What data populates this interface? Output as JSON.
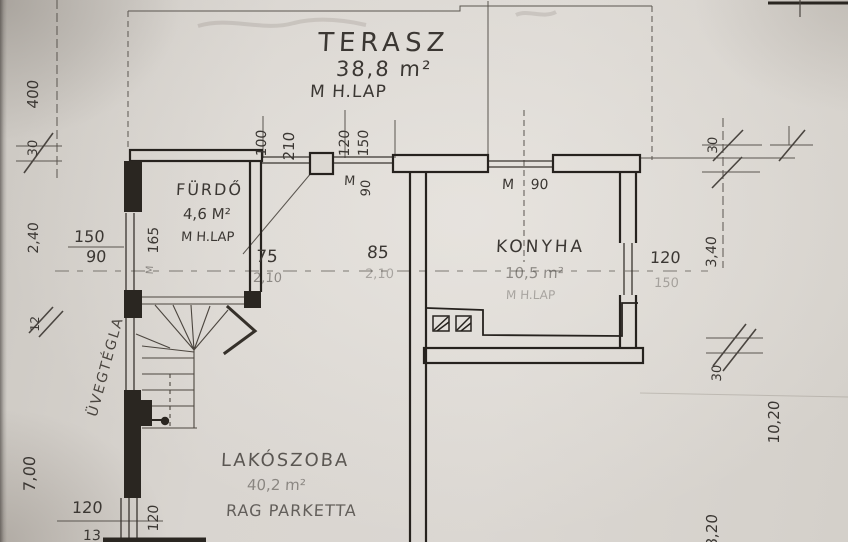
{
  "rooms": {
    "terasz": {
      "name": "TERASZ",
      "area": "38,8 m²",
      "floor": "M H.LAP"
    },
    "furdo": {
      "name": "FÜRDŐ",
      "area": "4,6 M²",
      "floor": "M H.LAP"
    },
    "konyha": {
      "name": "KONYHA",
      "area": "10,5 m²",
      "floor": "M H.LAP"
    },
    "lakoszoba": {
      "name": "LAKÓSZOBA",
      "area": "40,2 m²",
      "floor": "RAG PARKETTA"
    }
  },
  "materials": {
    "glass_brick": "ÜVEGTÉGLA"
  },
  "openings": {
    "terrace_door_side": "100",
    "terrace_door_width": "210",
    "top_window_width": "120",
    "top_window_height": "150",
    "pillar_parapet_label": "M",
    "pillar_parapet_height": "90",
    "kitchen_window_label": "M 90",
    "left_window_width": "150",
    "left_window_height": "90",
    "furdo_door_mark": "M",
    "furdo_door_width": "75",
    "furdo_door_height": "2,10",
    "hall_door_width": "85",
    "hall_door_height": "2,10",
    "kitchen_right_window_width": "120",
    "kitchen_right_window_height": "150"
  },
  "dimensions": {
    "left_total": "400",
    "left_offset_top": "30",
    "left_h1": "2,40",
    "furdo_width": "165",
    "left_hash": "12",
    "left_h2": "7,00",
    "bottom_left_width": "120",
    "bottom_left_wall": "120",
    "bottom_left_cut": "13",
    "right_offset_top": "30",
    "right_h1": "3,40",
    "right_hash": "30",
    "right_total": "10,20",
    "right_h2": "8,20"
  },
  "colors": {
    "paper": "#d8d4cf",
    "ink": "#2a2621",
    "ink_light": "#5a554f"
  }
}
